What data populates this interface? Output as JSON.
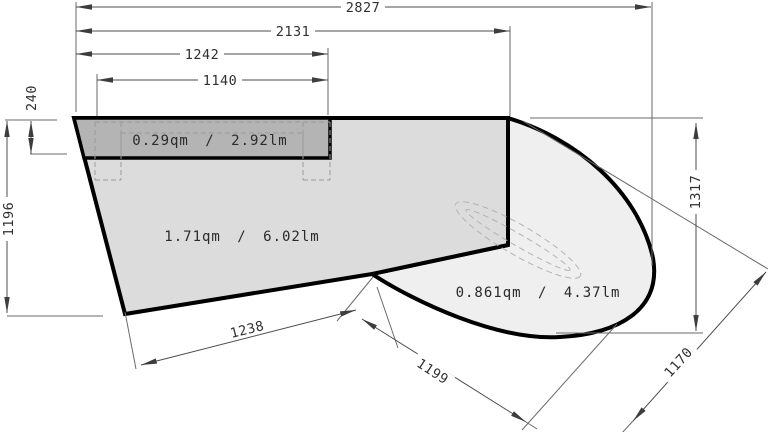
{
  "drawing": {
    "title": "countertop-cad-dimension-drawing",
    "areas": {
      "strip_label": "0.29qm / 2.92lm",
      "main_label": "1.71qm / 6.02lm",
      "curved_label": "0.861qm / 4.37lm"
    },
    "dimensions": {
      "top_outer": "2827",
      "top_mid": "2131",
      "top_inner": "1242",
      "top_innermost": "1140",
      "left_small": "240",
      "left_height": "1196",
      "right_height": "1317",
      "bottom_left_edge": "1238",
      "bottom_diag": "1199",
      "bottom_right_diag": "1170"
    },
    "colors": {
      "strip_fill": "#b4b4b4",
      "main_fill": "#dcdcdc",
      "curved_fill": "#efefef",
      "outline": "#000000",
      "dimension": "#4d4d4d"
    }
  }
}
